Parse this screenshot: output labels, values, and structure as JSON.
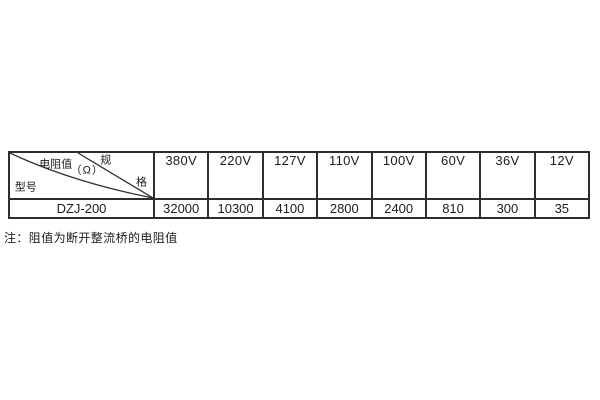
{
  "page": {
    "background": "#ffffff",
    "text_color": "#1c1c1c",
    "border_color": "#2d2d2d"
  },
  "table": {
    "corner": {
      "spec_char_top": "规",
      "spec_char_bottom": "格",
      "value_label": "电阻值",
      "unit_label": "（Ω）",
      "model_label": "型号"
    },
    "voltage_headers": [
      "380V",
      "220V",
      "127V",
      "110V",
      "100V",
      "60V",
      "36V",
      "12V"
    ],
    "row": {
      "model": "DZJ-200",
      "values": [
        "32000",
        "10300",
        "4100",
        "2800",
        "2400",
        "810",
        "300",
        "35"
      ]
    }
  },
  "note": {
    "text": "注：阻值为断开整流桥的电阻值"
  }
}
